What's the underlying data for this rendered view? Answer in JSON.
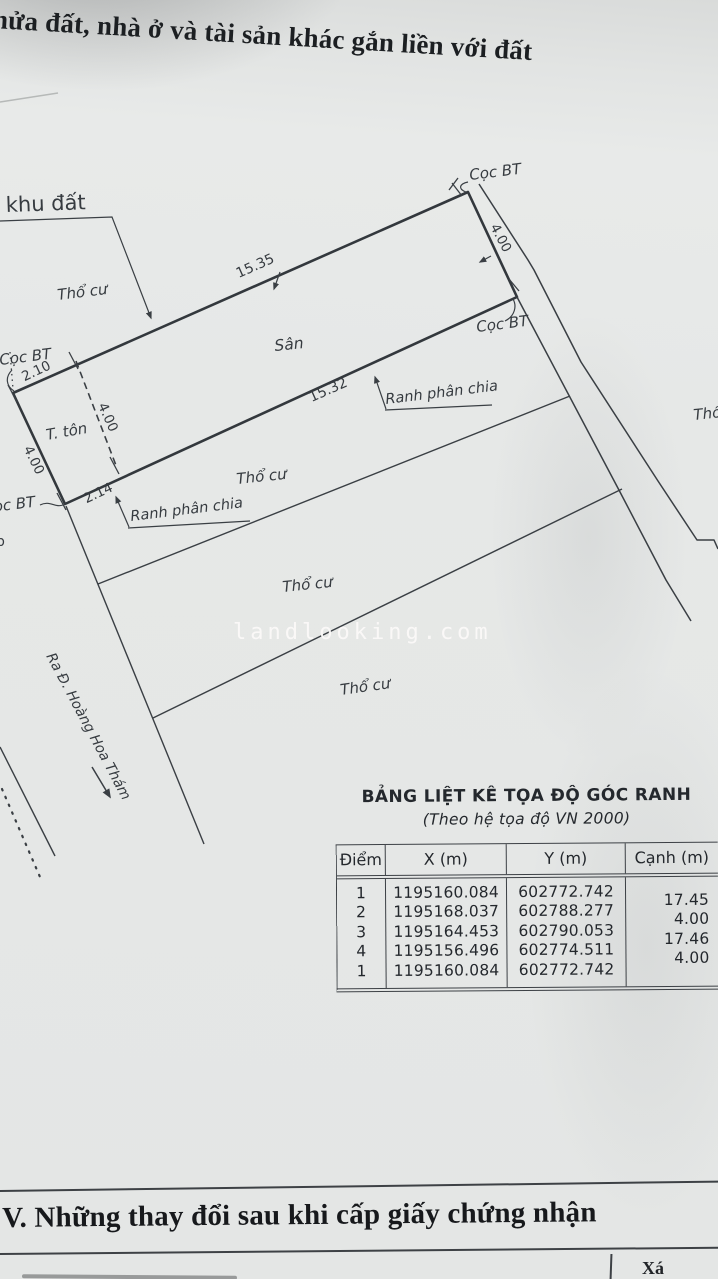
{
  "header": {
    "title": "hửa đất, nhà ở và tài sản khác gắn liền với đất"
  },
  "watermark": {
    "text": "landlooking.com"
  },
  "drawing": {
    "area_label": "khu đất",
    "residential_label": "Thổ cư",
    "yard_label": "Sân",
    "shed_label": "T. tôn",
    "marker_label": "Cọc BT",
    "division_label": "Ranh phân chia",
    "street_label": "Ra Đ. Hoàng Hoa Thám",
    "partial_letter": "b",
    "dim_top": "15.35",
    "dim_mid": "15.32",
    "dim_left_top": "2.10",
    "dim_left_bottom": "2.14",
    "dim_width": "4.00"
  },
  "table": {
    "title": "BẢNG LIỆT KÊ TỌA ĐỘ GÓC RANH",
    "subtitle": "(Theo hệ tọa độ VN 2000)",
    "columns": [
      "Điểm",
      "X (m)",
      "Y (m)",
      "Cạnh (m)"
    ],
    "rows": [
      {
        "point": "1",
        "x": "1195160.084",
        "y": "602772.742"
      },
      {
        "point": "2",
        "x": "1195168.037",
        "y": "602788.277"
      },
      {
        "point": "3",
        "x": "1195164.453",
        "y": "602790.053"
      },
      {
        "point": "4",
        "x": "1195156.496",
        "y": "602774.511"
      },
      {
        "point": "1",
        "x": "1195160.084",
        "y": "602772.742"
      }
    ],
    "edges": [
      "17.45",
      "4.00",
      "17.46",
      "4.00"
    ]
  },
  "footer": {
    "section_title": "V. Những thay đổi sau khi cấp giấy chứng nhận",
    "partial_text": "Xá"
  },
  "colors": {
    "paper": "#e6e8e7",
    "ink": "#3a3f44",
    "text": "#2b3035",
    "watermark": "#f6f4f2"
  }
}
